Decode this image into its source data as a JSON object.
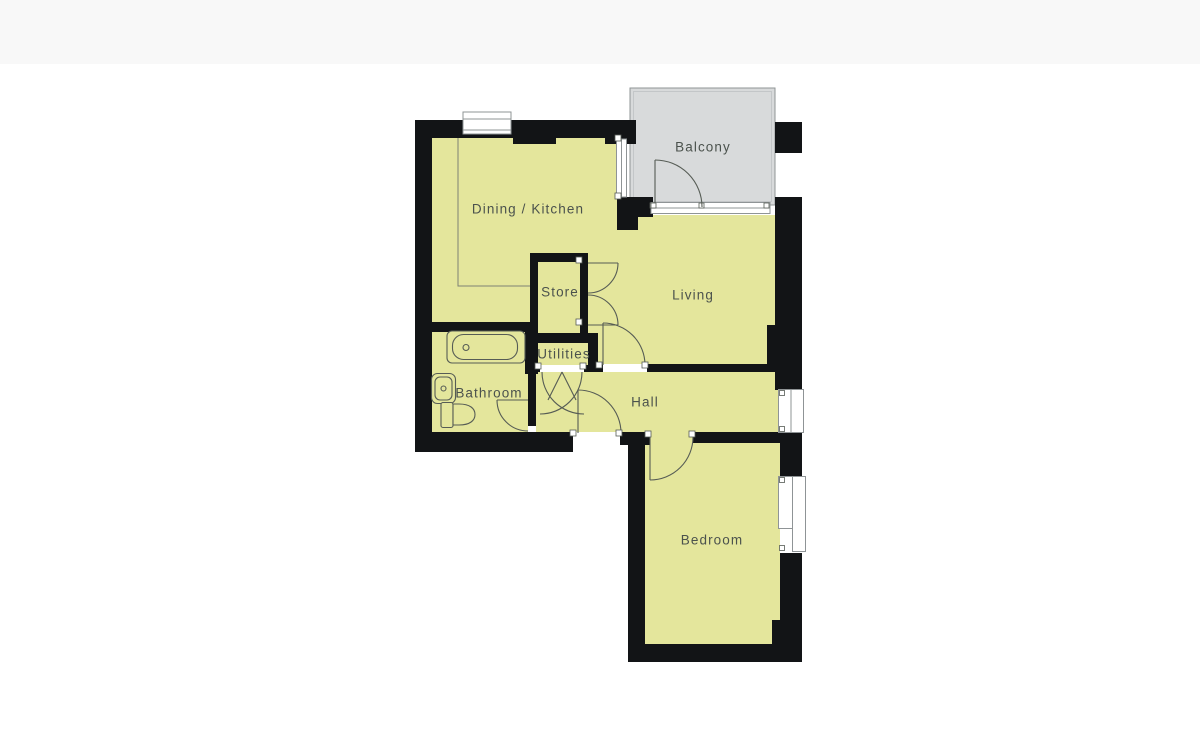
{
  "labels": {
    "balcony": "Balcony",
    "dining_kitchen": "Dining / Kitchen",
    "living": "Living",
    "store": "Store",
    "utilities": "Utilities",
    "bathroom": "Bathroom",
    "hall": "Hall",
    "bedroom": "Bedroom"
  },
  "fixtures": [
    "bathtub",
    "washbasin",
    "toilet"
  ],
  "colors": {
    "bg": "#ffffff",
    "band": "#f8f8f8",
    "wall": "#121416",
    "room": "#e4e69c",
    "balcony": "#d8dadb",
    "line": "#565c55",
    "label": "#4b524d",
    "frame": "#8f9496"
  }
}
